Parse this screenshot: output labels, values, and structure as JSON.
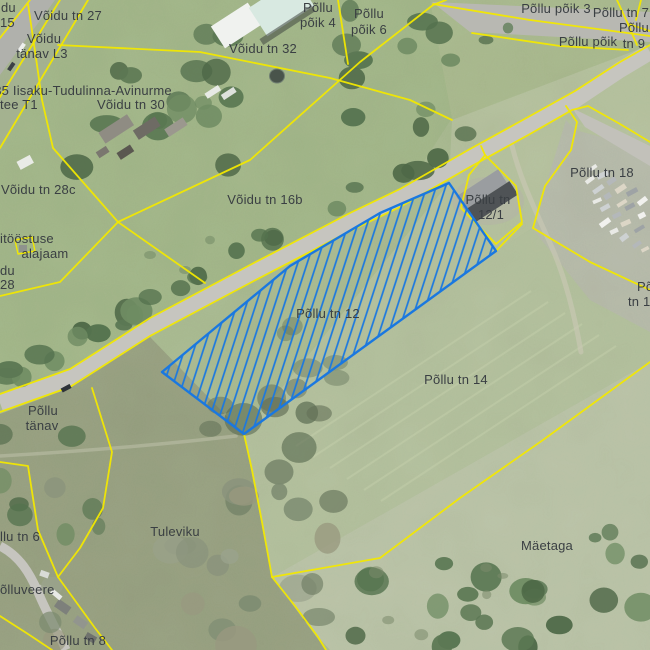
{
  "map": {
    "type": "cadastral-aerial-map",
    "selected_parcel": "Põllu tn 12",
    "colors": {
      "boundary": "#f2e800",
      "selection": "#1a78e0",
      "label": "#3a3f43",
      "road": "#c6c5bf",
      "grass": "#a9ba91"
    },
    "labels": [
      {
        "id": "frag-voidu-du-top",
        "text": "du",
        "x": 1,
        "y": 12,
        "anchor": "start"
      },
      {
        "id": "frag-tn-15",
        "text": "15",
        "x": 0,
        "y": 27,
        "anchor": "start"
      },
      {
        "id": "voidu-tn-27",
        "text": "Võidu tn 27",
        "x": 68,
        "y": 20
      },
      {
        "id": "voidu-tanav-l3-line1",
        "text": "Võidu",
        "x": 44,
        "y": 43
      },
      {
        "id": "voidu-tanav-l3-line2",
        "text": "tänav L3",
        "x": 42,
        "y": 58
      },
      {
        "id": "tee-35-line1",
        "text": "35 Iisaku-Tudulinna-Avinurme",
        "x": 83,
        "y": 95
      },
      {
        "id": "tee-35-line2",
        "text": "tee T1",
        "x": 0,
        "y": 109,
        "anchor": "start"
      },
      {
        "id": "voidu-tn-30",
        "text": "Võidu tn 30",
        "x": 131,
        "y": 109
      },
      {
        "id": "voidu-tn-32",
        "text": "Võidu tn 32",
        "x": 263,
        "y": 53
      },
      {
        "id": "pollu-poik-4-line1",
        "text": "Põllu",
        "x": 318,
        "y": 12
      },
      {
        "id": "pollu-poik-4-line2",
        "text": "põik 4",
        "x": 318,
        "y": 27
      },
      {
        "id": "pollu-poik-6-line1",
        "text": "Põllu",
        "x": 369,
        "y": 18
      },
      {
        "id": "pollu-poik-6-line2",
        "text": "põik 6",
        "x": 369,
        "y": 34
      },
      {
        "id": "pollu-poik-3",
        "text": "Põllu põik 3",
        "x": 556,
        "y": 13
      },
      {
        "id": "pollu-tn-7",
        "text": "Põllu tn 7",
        "x": 621,
        "y": 17
      },
      {
        "id": "frag-pollu-tn-9-line1",
        "text": "Põllu",
        "x": 634,
        "y": 32
      },
      {
        "id": "pollu-poik-street",
        "text": "Põllu põik",
        "x": 588,
        "y": 46
      },
      {
        "id": "frag-pollu-tn-9-line2",
        "text": "tn 9",
        "x": 634,
        "y": 48
      },
      {
        "id": "voidu-tn-28c",
        "text": "Võidu tn 28c",
        "x": 1,
        "y": 194,
        "anchor": "start"
      },
      {
        "id": "frag-itoostuse",
        "text": "itööstuse",
        "x": 0,
        "y": 243,
        "anchor": "start"
      },
      {
        "id": "alajaam",
        "text": "alajaam",
        "x": 45,
        "y": 258
      },
      {
        "id": "frag-voidu-du-left",
        "text": "du",
        "x": 0,
        "y": 275,
        "anchor": "start"
      },
      {
        "id": "frag-tn-28",
        "text": "28",
        "x": 0,
        "y": 289,
        "anchor": "start"
      },
      {
        "id": "voidu-tn-16b",
        "text": "Võidu tn 16b",
        "x": 265,
        "y": 204
      },
      {
        "id": "pollu-tn-12-1-line1",
        "text": "Põllu tn",
        "x": 488,
        "y": 204
      },
      {
        "id": "pollu-tn-12-1-line2",
        "text": "12/1",
        "x": 491,
        "y": 219
      },
      {
        "id": "pollu-tn-18",
        "text": "Põllu tn 18",
        "x": 602,
        "y": 177
      },
      {
        "id": "pollu-tn-12",
        "text": "Põllu tn 12",
        "x": 328,
        "y": 318
      },
      {
        "id": "pollu-tn-14",
        "text": "Põllu tn 14",
        "x": 456,
        "y": 384
      },
      {
        "id": "pollu-tanav-line1",
        "text": "Põllu",
        "x": 43,
        "y": 415
      },
      {
        "id": "pollu-tanav-line2",
        "text": "tänav",
        "x": 42,
        "y": 430
      },
      {
        "id": "frag-pollu-tn-6",
        "text": "llu tn 6",
        "x": 0,
        "y": 541,
        "anchor": "start"
      },
      {
        "id": "tuleviku",
        "text": "Tuleviku",
        "x": 175,
        "y": 536
      },
      {
        "id": "maetaga",
        "text": "Mäetaga",
        "x": 547,
        "y": 550
      },
      {
        "id": "frag-polluveere",
        "text": "õlluveere",
        "x": 0,
        "y": 594,
        "anchor": "start"
      },
      {
        "id": "pollu-tn-8",
        "text": "Põllu tn 8",
        "x": 78,
        "y": 645
      },
      {
        "id": "frag-pollu-tn-1x-line1",
        "text": "Põ",
        "x": 637,
        "y": 291,
        "anchor": "start"
      },
      {
        "id": "frag-pollu-tn-1x-line2",
        "text": "tn 1",
        "x": 628,
        "y": 306,
        "anchor": "start"
      }
    ]
  }
}
